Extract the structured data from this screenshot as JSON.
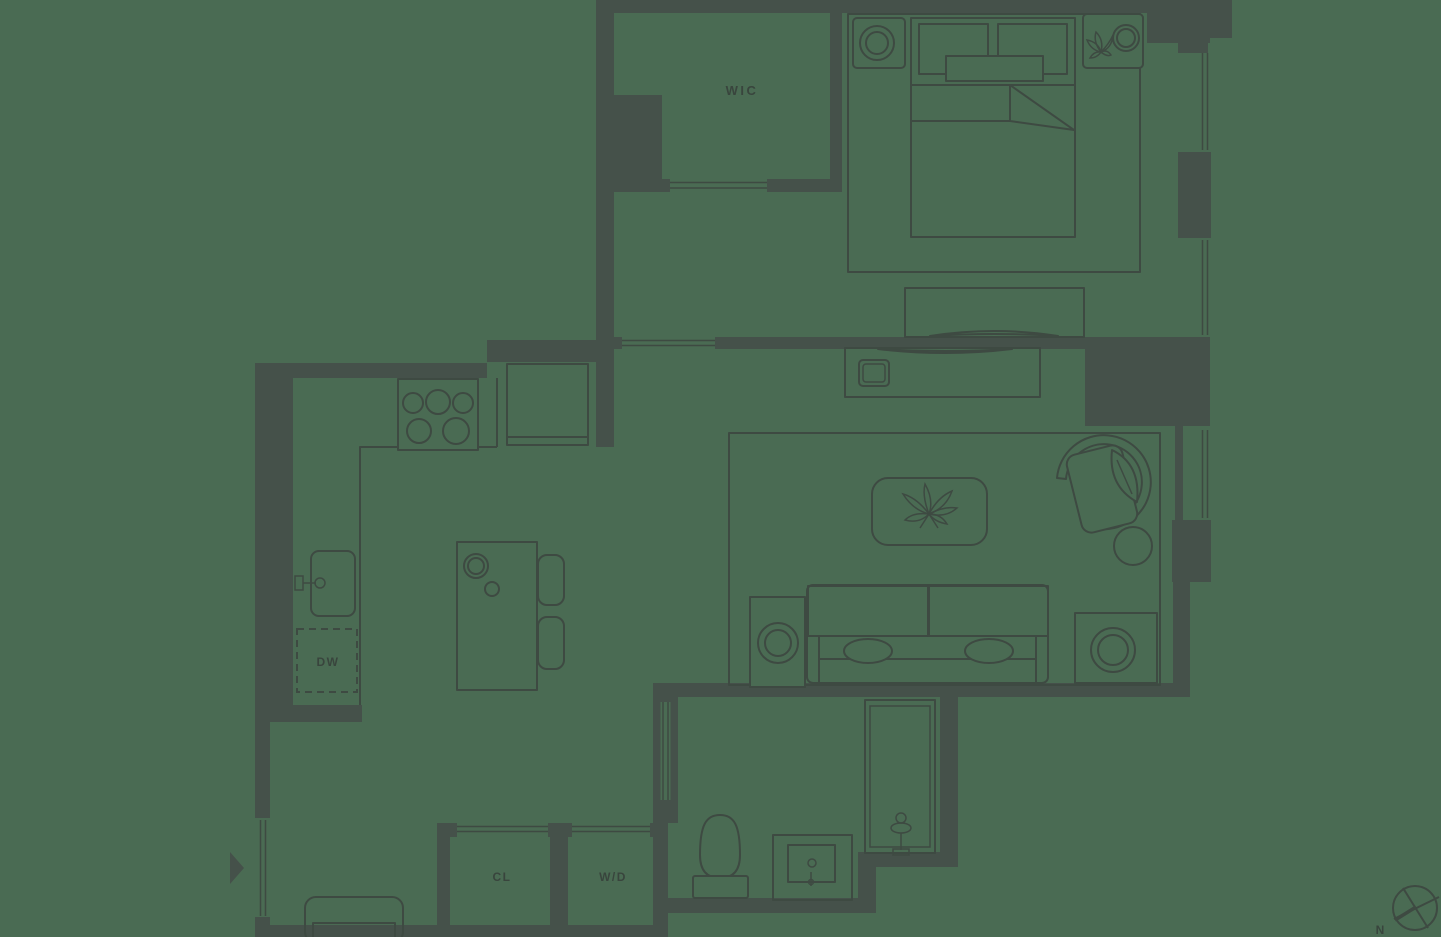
{
  "colors": {
    "background": "#4A6B53",
    "wall": "#45514A",
    "line": "#3E4A42",
    "label": "#39453D"
  },
  "labels": {
    "walk_in_closet": "WIC",
    "dishwasher": "DW",
    "closet": "CL",
    "washer_dryer": "W/D",
    "north": "N"
  }
}
